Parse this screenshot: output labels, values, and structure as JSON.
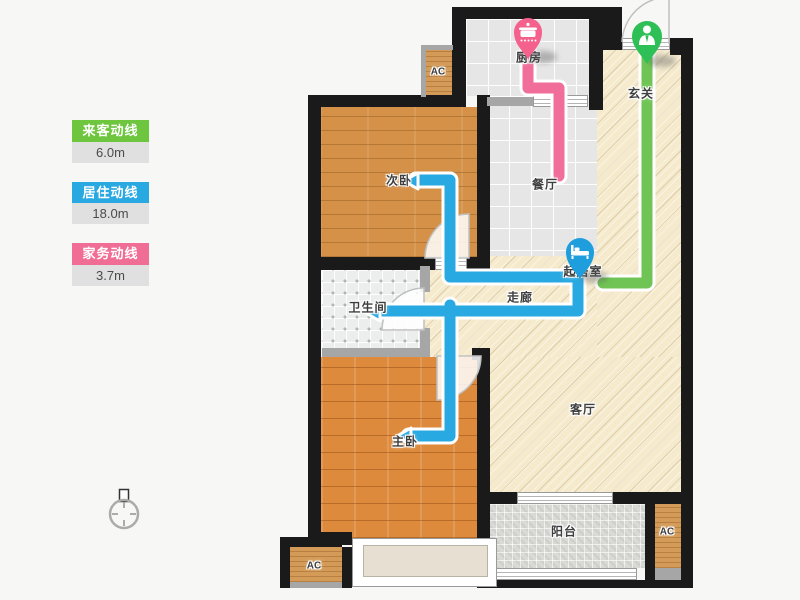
{
  "legend": {
    "items": [
      {
        "label": "来客动线",
        "value": "6.0m",
        "color": "#6ec53e"
      },
      {
        "label": "居住动线",
        "value": "18.0m",
        "color": "#29a9e1"
      },
      {
        "label": "家务动线",
        "value": "3.7m",
        "color": "#f06e96"
      }
    ]
  },
  "rooms": {
    "kitchen": "厨房",
    "entrance": "玄关",
    "second_bedroom": "次卧",
    "dining": "餐厅",
    "living_start": "起居室",
    "corridor": "走廊",
    "bathroom": "卫生间",
    "living": "客厅",
    "master_bedroom": "主卧",
    "balcony": "阳台",
    "ac": "AC"
  },
  "icons": {
    "kitchen_pin": "pot-icon",
    "entrance_pin": "person-icon",
    "living_pin": "bed-icon",
    "compass": "compass-icon"
  },
  "colors": {
    "visitor_line": "#70c455",
    "resident_line": "#29a9e1",
    "housework_line": "#f06e99",
    "visitor_pin": "#2fbf57",
    "resident_pin": "#1e9edc",
    "housework_pin": "#f4618d",
    "wall": "#1a1a1a",
    "floor_beige": "#f5eacc",
    "floor_tile": "#e6e6e6",
    "wood_second_bedroom": "#d69148",
    "wood_master_bedroom": "#dd8a3c"
  }
}
